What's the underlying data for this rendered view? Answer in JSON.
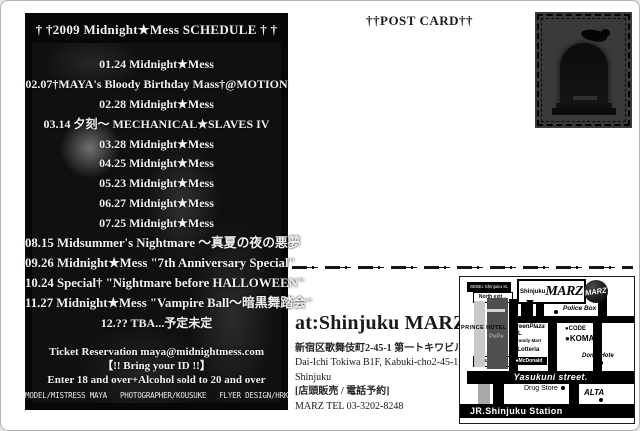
{
  "colors": {
    "page_bg": "#ffffff",
    "panel_bg": "#070707",
    "ink": "#1a1a1a",
    "map_street": "#000000"
  },
  "flyer": {
    "title": "† †2009 Midnight★Mess SCHEDULE † †",
    "schedule": [
      "01.24 Midnight★Mess",
      "02.07†MAYA's Bloody Birthday Mass†@MOTION",
      "02.28 Midnight★Mess",
      "03.14 夕刻～ MECHANICAL★SLAVES IV",
      "03.28 Midnight★Mess",
      "04.25 Midnight★Mess",
      "05.23 Midnight★Mess",
      "06.27 Midnight★Mess",
      "07.25 Midnight★Mess",
      "08.15 Midsummer's Nightmare ～真夏の夜の悪夢",
      "09.26 Midnight★Mess \"7th Anniversary Special\"",
      "10.24 Special† \"Nightmare before HALLOWEEN\"",
      "11.27 Midnight★Mess \"Vampire Ball～暗黒舞踏会\"",
      "12.?? TBA...予定未定"
    ],
    "ticket_lines": [
      "Ticket Reservation maya@midnightmess.com",
      "【!! Bring your ID !!】",
      "Enter 18 and over+Alcohol sold to 20 and over"
    ],
    "credits": "MODEL/MISTRESS MAYA   PHOTOGRAPHER/KOUSUKE   FLYER DESIGN/HRK:S"
  },
  "postcard": {
    "label": "††POST CARD††"
  },
  "venue": {
    "heading": "at:Shinjuku MARZ",
    "address_jp": "新宿区歌舞伎町2-45-1 第一トキワビルB1F",
    "address_en1": "Dai-Ichi Tokiwa B1F, Kabuki-cho2-45-1,",
    "address_en2": "Shinjuku",
    "sales": "[店頭販売 / 電話予約]",
    "tel": "MARZ  TEL 03-3202-8248"
  },
  "map": {
    "seibu": "SEIBU Shinjuku st.",
    "north_exit": "North exit→",
    "south_exit": "South exit→",
    "prince_hotel": "PRINCE HOTEL",
    "pepe": "PePe",
    "marz_label_small": "Shinjuku",
    "marz_label_big": "MARZ",
    "logo_text": "MARZ",
    "police_box": "Police Box",
    "green_plaza": "GreenPlaza",
    "green_plaza_el": "EL",
    "family_mart": "● Family Mart",
    "lotteria": "● Lotteria",
    "mcdonald": "●McDonald",
    "code": "●CODE",
    "koma": "●KOMA",
    "donki": "Donki Hote",
    "yasukuni": "Yasukuni street.",
    "drug_store": "Drug Store",
    "alta": "ALTA",
    "jr_station": "JR.Shinjuku Station"
  }
}
